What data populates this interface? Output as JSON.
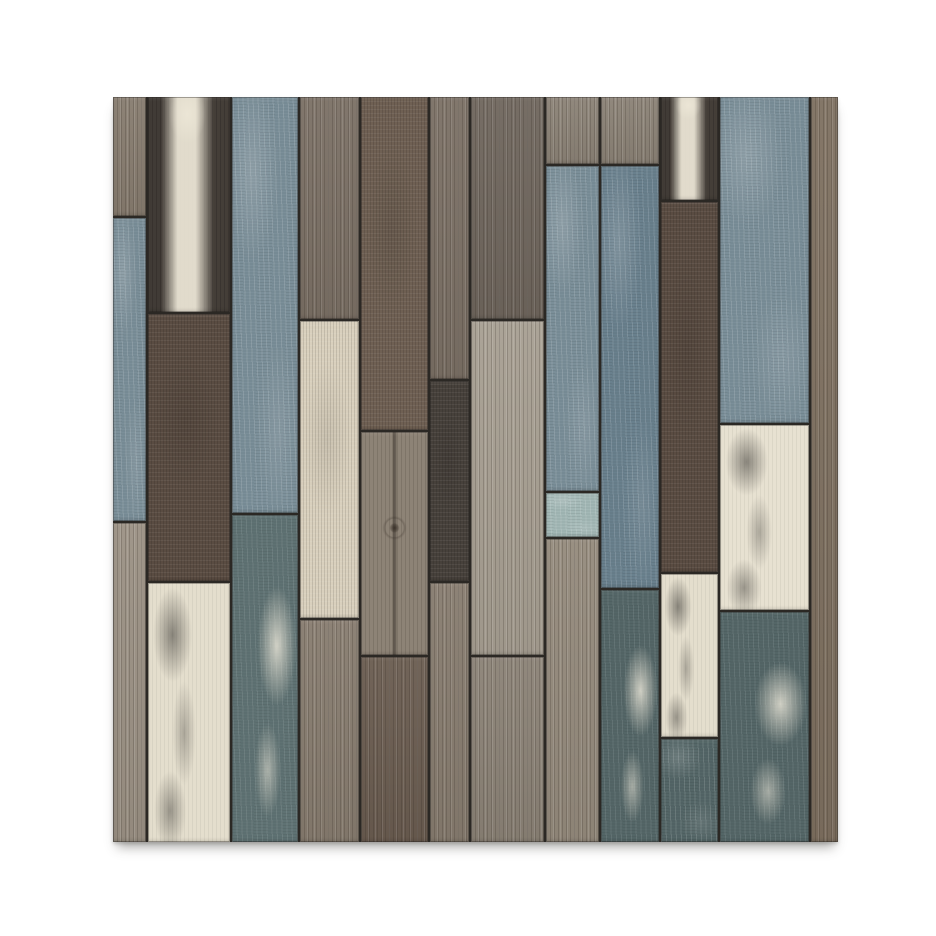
{
  "image": {
    "description": "Product photo of a square rustic wood-plank wall panel (peel-and-stick 3D wallpaper tile) with vertical weathered planks in steel blue, gray, brown and distressed cream, centered on a plain white background with a soft drop shadow below.",
    "background_color": "#ffffff",
    "seam_color": "#2b2824"
  },
  "palette": {
    "wood1": "#9b9184",
    "wood2": "#877c6f",
    "wood3": "#7b7065",
    "woodGray": "#8b8276",
    "woodGrayDark": "#6f665d",
    "woodSilver": "#a79f92",
    "woodGrain2": "#948a7c",
    "woodKnot": "#8d8376",
    "woodBrown": "#7e7060",
    "brown1": "#5a4c42",
    "brown2": "#6f6053",
    "brown3": "#6a5c50",
    "charcoal": "#47413b",
    "darkStreak": "#4b443e",
    "blue1": "#7b8f99",
    "blue2": "#69808d",
    "tealDark": "#546667",
    "tealLight": "#a3b8b6",
    "tealWhite": "#5f7273",
    "cream1": "#d9d0bd",
    "creamLight": "#e7e1d1",
    "creamBlotch": "#e4decd"
  },
  "panel": {
    "columns": [
      {
        "width": 34,
        "segments": [
          {
            "color": "wood2",
            "texture": "grain",
            "h": 16
          },
          {
            "color": "blue1",
            "texture": "rough",
            "h": 41
          },
          {
            "color": "wood1",
            "texture": "grain",
            "h": 43
          }
        ]
      },
      {
        "width": 85,
        "segments": [
          {
            "color": "darkStreak",
            "texture": "streak",
            "h": 29
          },
          {
            "color": "brown1",
            "texture": "noise",
            "h": 36
          },
          {
            "color": "creamBlotch",
            "texture": "blotch",
            "h": 35
          }
        ]
      },
      {
        "width": 68,
        "segments": [
          {
            "color": "blue1",
            "texture": "rough",
            "h": 56
          },
          {
            "color": "tealWhite",
            "texture": "patch",
            "h": 44
          }
        ]
      },
      {
        "width": 60,
        "segments": [
          {
            "color": "wood3",
            "texture": "grain",
            "h": 30
          },
          {
            "color": "cream1",
            "texture": "noise",
            "h": 40
          },
          {
            "color": "wood2",
            "texture": "grain",
            "h": 30
          }
        ]
      },
      {
        "width": 70,
        "segments": [
          {
            "color": "brown2",
            "texture": "noise",
            "h": 45
          },
          {
            "color": "woodKnot",
            "texture": "knot",
            "h": 30
          },
          {
            "color": "brown3",
            "texture": "grain",
            "h": 25
          }
        ]
      },
      {
        "width": 40,
        "segments": [
          {
            "color": "wood3",
            "texture": "grain",
            "h": 38
          },
          {
            "color": "charcoal",
            "texture": "noise",
            "h": 27
          },
          {
            "color": "wood2",
            "texture": "grain",
            "h": 35
          }
        ]
      },
      {
        "width": 75,
        "segments": [
          {
            "color": "woodGrayDark",
            "texture": "grain",
            "h": 30
          },
          {
            "color": "woodSilver",
            "texture": "grain",
            "h": 45
          },
          {
            "color": "woodGray",
            "texture": "grain",
            "h": 25
          }
        ]
      },
      {
        "width": 55,
        "segments": [
          {
            "color": "woodGray",
            "texture": "grain",
            "h": 9
          },
          {
            "color": "blue1",
            "texture": "rough",
            "h": 44
          },
          {
            "color": "tealLight",
            "texture": "rough",
            "h": 6
          },
          {
            "color": "woodGrain2",
            "texture": "grain",
            "h": 41
          }
        ]
      },
      {
        "width": 60,
        "segments": [
          {
            "color": "woodGray",
            "texture": "grain",
            "h": 9
          },
          {
            "color": "blue2",
            "texture": "rough",
            "h": 57
          },
          {
            "color": "tealDark",
            "texture": "patch",
            "h": 34
          }
        ]
      },
      {
        "width": 58,
        "segments": [
          {
            "color": "darkStreak",
            "texture": "streak",
            "h": 14
          },
          {
            "color": "brown1",
            "texture": "noise",
            "h": 50
          },
          {
            "color": "creamBlotch",
            "texture": "blotch",
            "h": 22
          },
          {
            "color": "tealDark",
            "texture": "rough",
            "h": 14
          }
        ]
      },
      {
        "width": 92,
        "segments": [
          {
            "color": "blue1",
            "texture": "rough",
            "h": 44
          },
          {
            "color": "creamLight",
            "texture": "blotch",
            "h": 25
          },
          {
            "color": "tealDark",
            "texture": "patch",
            "h": 31
          }
        ]
      },
      {
        "width": 28,
        "segments": [
          {
            "color": "woodBrown",
            "texture": "grain",
            "h": 100
          }
        ]
      }
    ]
  }
}
